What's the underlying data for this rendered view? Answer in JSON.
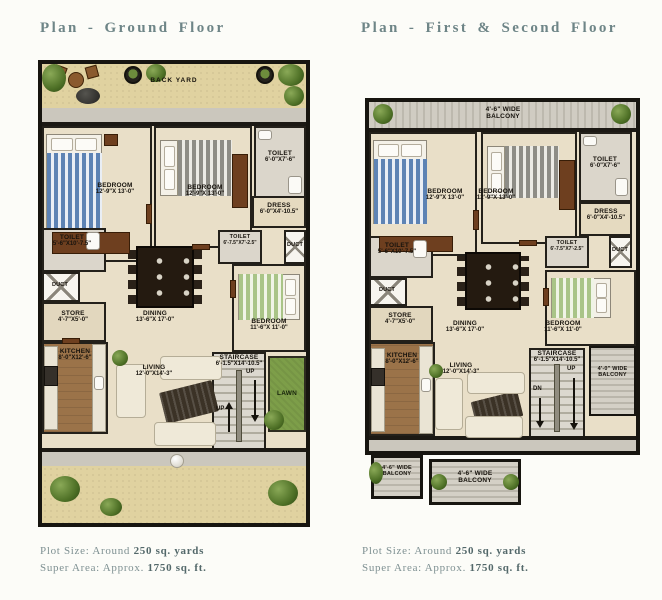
{
  "ground": {
    "title": "Plan - Ground Floor",
    "back_yard": "BACK YARD",
    "lawn": "LAWN",
    "up1": "UP",
    "up2": "UP",
    "rooms": {
      "bedroom1": {
        "name": "BEDROOM",
        "dim": "12'-9\"X 13'-0\""
      },
      "bedroom2": {
        "name": "BEDROOM",
        "dim": "12'-9\"X 13'-0\""
      },
      "toilet_top_right": {
        "name": "TOILET",
        "dim": "6'-0\"X7'-6\""
      },
      "dress": {
        "name": "DRESS",
        "dim": "6'-0\"X4'-10.5\""
      },
      "toilet_mid": {
        "name": "TOILET",
        "dim": "6'-7.5\"X7'-2.5\""
      },
      "duct_right": {
        "name": "DUCT"
      },
      "toilet_left": {
        "name": "TOILET",
        "dim": "5'-6\"X10'-7.5\""
      },
      "duct_left": {
        "name": "DUCT"
      },
      "store": {
        "name": "STORE",
        "dim": "4'-7\"X5'-0\""
      },
      "kitchen": {
        "name": "KITCHEN",
        "dim": "8'-0\"X12'-6\""
      },
      "dining": {
        "name": "DINING",
        "dim": "13'-6\"X 17'-0\""
      },
      "bedroom3": {
        "name": "BEDROOM",
        "dim": "11'-6\"X 11'-0\""
      },
      "staircase": {
        "name": "STAIRCASE",
        "dim": "6'-1.5\"X14'-10.5\""
      },
      "living": {
        "name": "LIVING",
        "dim": "12'-0\"X14'-3\""
      }
    }
  },
  "upper": {
    "title": "Plan - First & Second Floor",
    "up": "UP",
    "dn": "DN",
    "balcony_top": {
      "line1": "4'-6\" WIDE",
      "line2": "BALCONY"
    },
    "balcony_right": {
      "line1": "4'-0\" WIDE",
      "line2": "BALCONY"
    },
    "balcony_bottom_left": {
      "line1": "4'-6\" WIDE",
      "line2": "BALCONY"
    },
    "balcony_bottom_center": {
      "line1": "4'-6\" WIDE",
      "line2": "BALCONY"
    },
    "rooms": {
      "bedroom1": {
        "name": "BEDROOM",
        "dim": "12'-9\"X 13'-0\""
      },
      "bedroom2": {
        "name": "BEDROOM",
        "dim": "12'-9\"X 13'-0\""
      },
      "toilet_top_right": {
        "name": "TOILET",
        "dim": "6'-0\"X7'-6\""
      },
      "dress": {
        "name": "DRESS",
        "dim": "6'-0\"X4'-10.5\""
      },
      "toilet_mid": {
        "name": "TOILET",
        "dim": "6'-7.5\"X7'-2.5\""
      },
      "duct_right": {
        "name": "DUCT"
      },
      "toilet_left": {
        "name": "TOILET",
        "dim": "5'-6\"X10'-7.5\""
      },
      "duct_left": {
        "name": "DUCT"
      },
      "store": {
        "name": "STORE",
        "dim": "4'-7\"X5'-0\""
      },
      "kitchen": {
        "name": "KITCHEN",
        "dim": "8'-0\"X12'-6\""
      },
      "dining": {
        "name": "DINING",
        "dim": "13'-6\"X 17'-0\""
      },
      "bedroom3": {
        "name": "BEDROOM",
        "dim": "11'-6\"X 11'-0\""
      },
      "staircase": {
        "name": "STAIRCASE",
        "dim": "6'-1.5\"X14'-10.5\""
      },
      "living": {
        "name": "LIVING",
        "dim": "12'-0\"X14'-3\""
      }
    }
  },
  "captions": {
    "plot_prefix": "Plot Size: Around ",
    "plot_bold": "250 sq. yards",
    "area_prefix": "Super Area: Approx. ",
    "area_bold": "1750 sq. ft."
  },
  "colors": {
    "title": "#6e8587",
    "wall": "#1c1914",
    "sand": "#e0d2a0",
    "floor": "#e9dfc8",
    "lawn": "#7d9e49"
  }
}
